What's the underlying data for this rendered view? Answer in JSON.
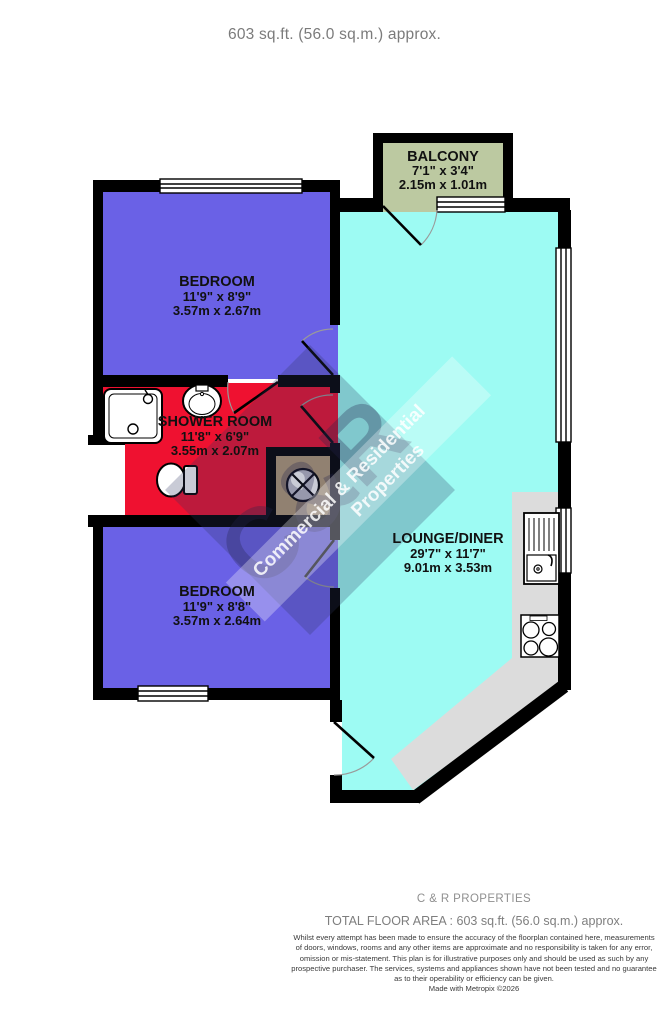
{
  "title": "603 sq.ft. (56.0 sq.m.) approx.",
  "rooms": [
    {
      "name": "BALCONY",
      "imperial": "7'1\"  x 3'4\"",
      "metric": "2.15m  x 1.01m"
    },
    {
      "name": "BEDROOM",
      "imperial": "11'9\"  x 8'9\"",
      "metric": "3.57m  x 2.67m"
    },
    {
      "name": "SHOWER ROOM",
      "imperial": "11'8\"  x 6'9\"",
      "metric": "3.55m  x 2.07m"
    },
    {
      "name": "BEDROOM",
      "imperial": "11'9\"  x 8'8\"",
      "metric": "3.57m  x 2.64m"
    },
    {
      "name": "LOUNGE/DINER",
      "imperial": "29'7\"  x 11'7\"",
      "metric": "9.01m  x 3.53m"
    }
  ],
  "colors": {
    "bedroom": "#6a61e6",
    "shower": "#ef1130",
    "lounge": "#9dfbf3",
    "balcony": "#bcc9a1",
    "cupboard": "#b49b77",
    "counter": "#dcdcdc",
    "wall": "#000000"
  },
  "watermark": {
    "logo": "C&R",
    "line1": "Commercial & Residential",
    "line2": "Properties"
  },
  "footer": {
    "company": "C & R PROPERTIES",
    "total_area": "TOTAL FLOOR AREA : 603 sq.ft. (56.0 sq.m.) approx.",
    "disclaimer_lines": [
      "Whilst every attempt has been made to ensure the accuracy of the floorplan contained here, measurements",
      "of doors, windows, rooms and any other items are approximate and no responsibility is taken for any error,",
      "omission or mis-statement. This plan is for illustrative purposes only and should be used as such by any",
      "prospective purchaser. The services, systems and appliances shown have not been tested and no guarantee",
      "as to their operability or efficiency can be given."
    ],
    "credit": "Made with Metropix ©2026"
  }
}
